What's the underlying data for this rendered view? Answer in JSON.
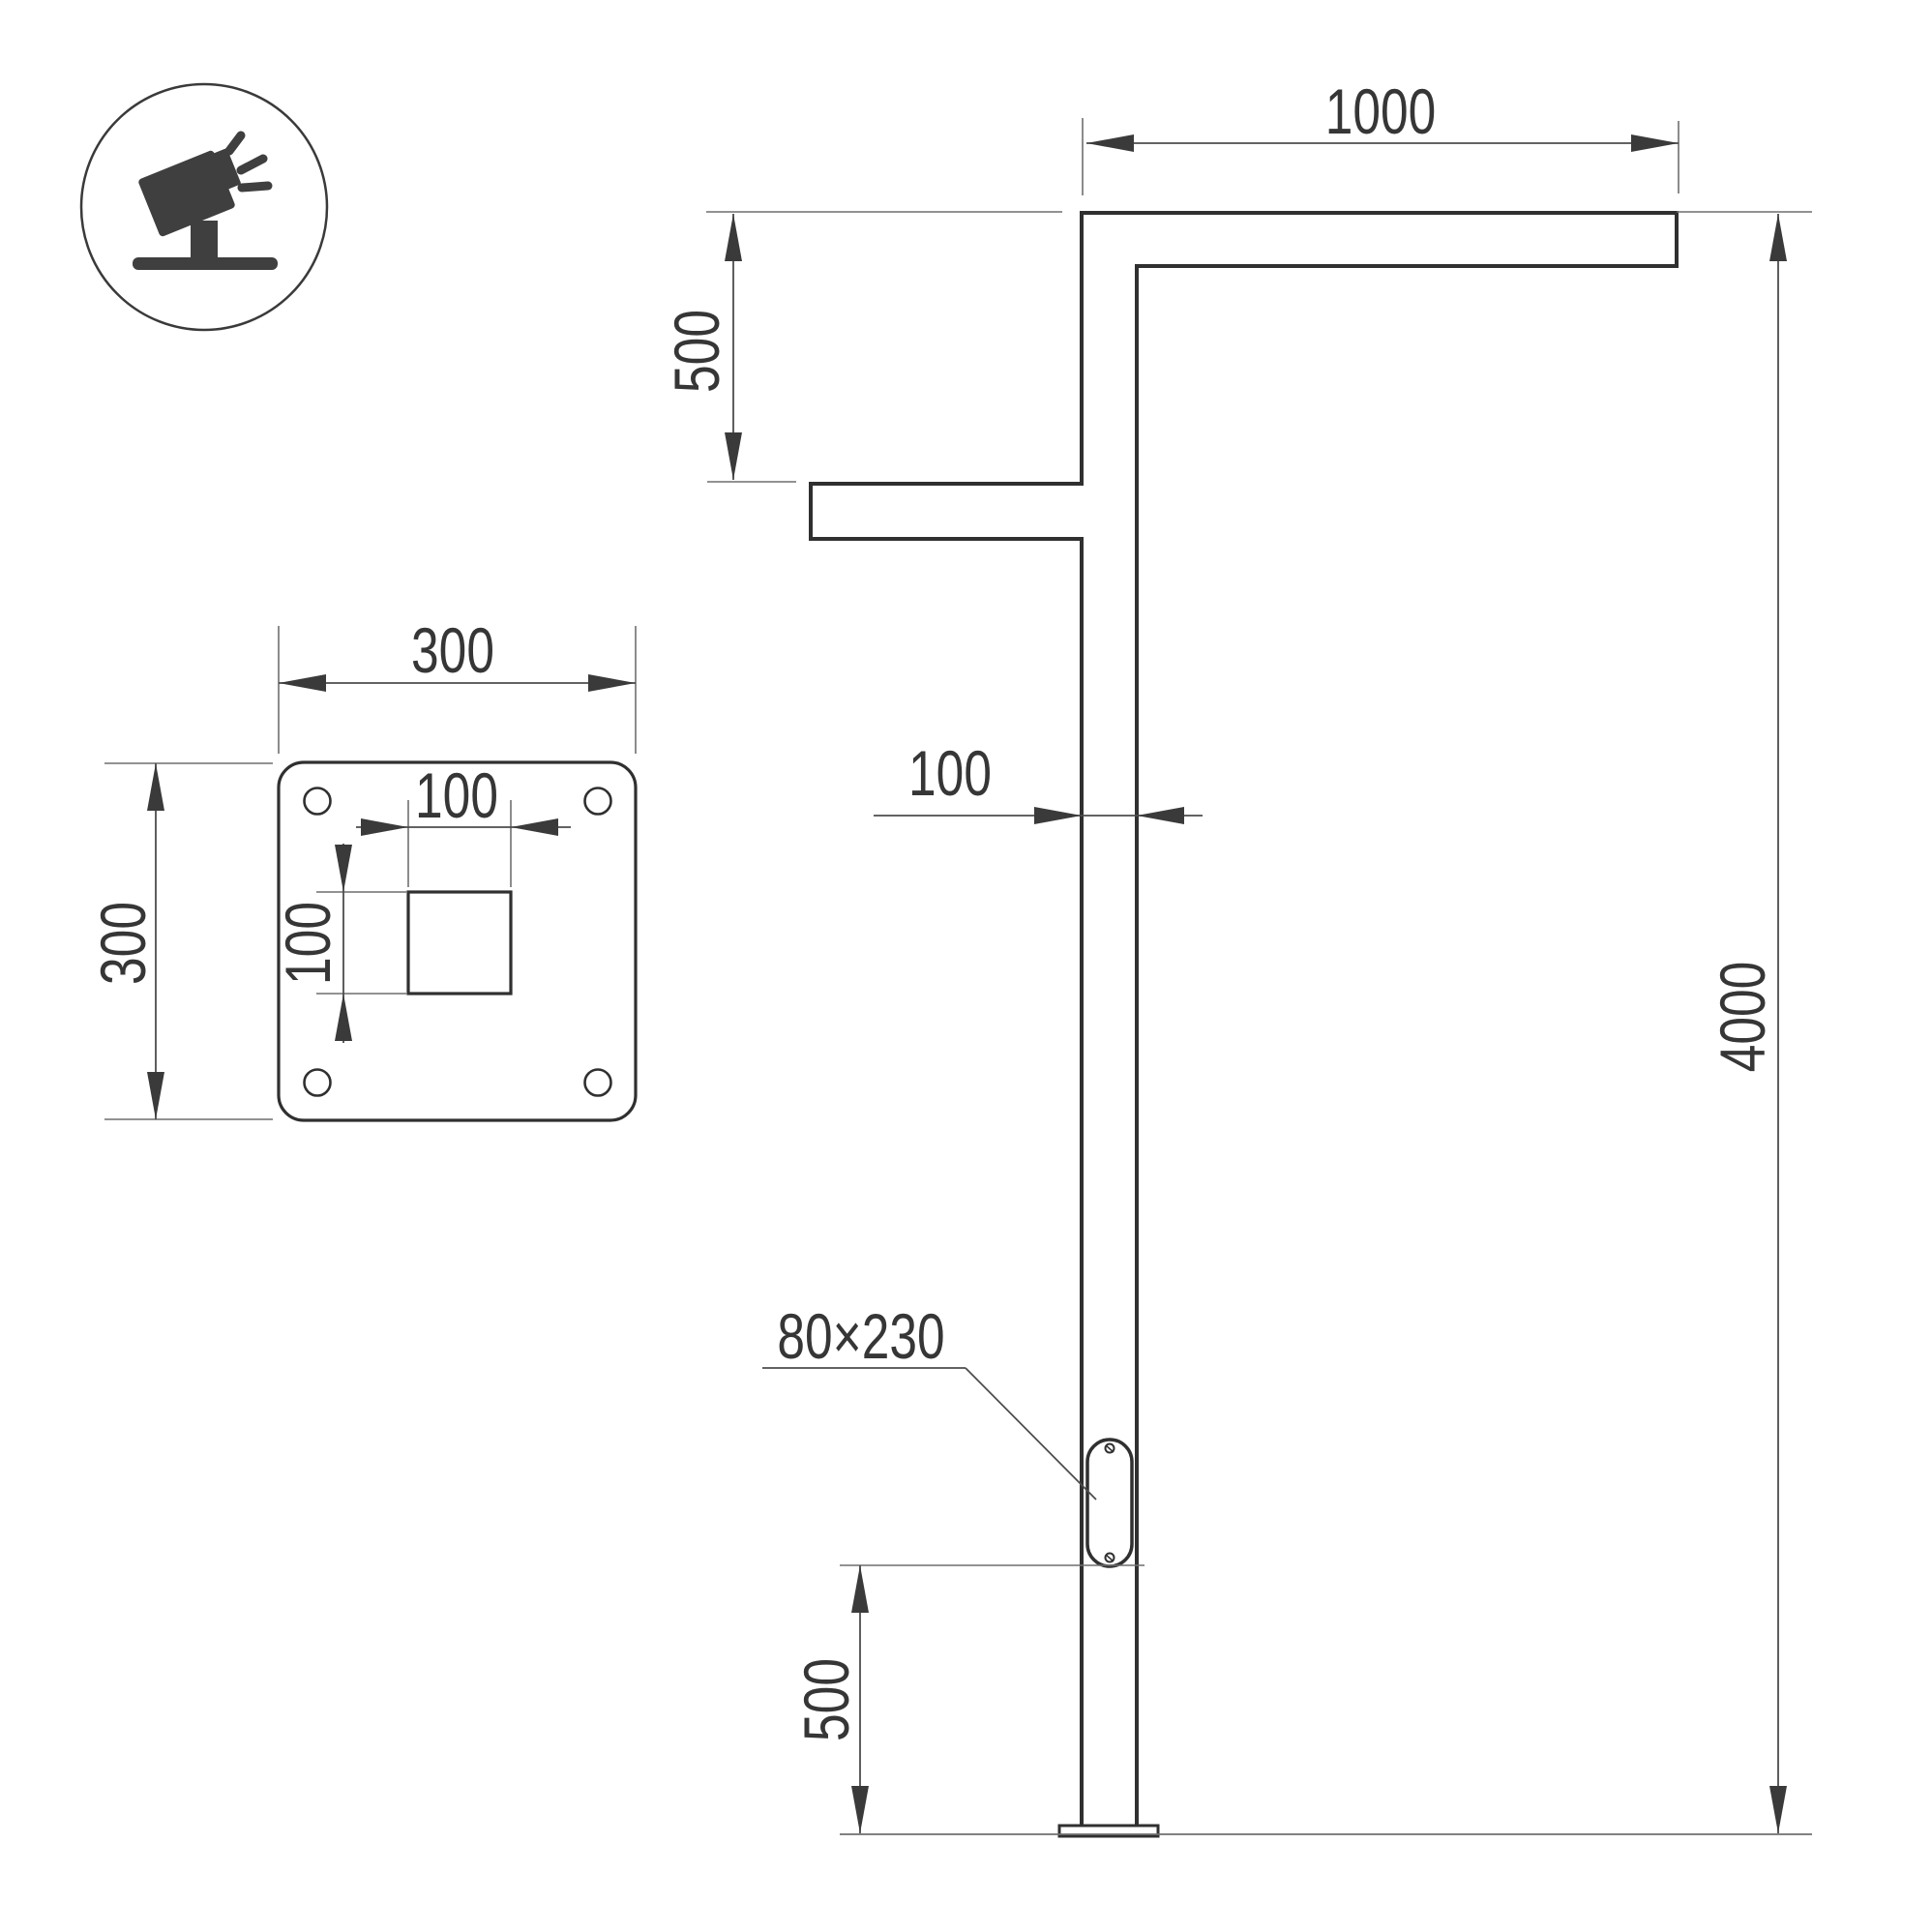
{
  "drawing": {
    "type": "street-light-pole-technical-drawing",
    "labels": {
      "arm_length": "1000",
      "arm_drop": "500",
      "pole_width": "100",
      "pole_height": "4000",
      "door_size": "80×230",
      "door_bottom_height": "500",
      "plate_width": "300",
      "plate_height": "300",
      "pocket_width": "100",
      "pocket_height": "100"
    },
    "icon": "tilted-floodlight-icon",
    "colors": {
      "outline": "#303030",
      "dimension_line": "#4d4d4d",
      "extension_line": "#6f6f6f",
      "arrow": "#3a3a3a",
      "text": "#363636",
      "background": "#ffffff"
    }
  }
}
